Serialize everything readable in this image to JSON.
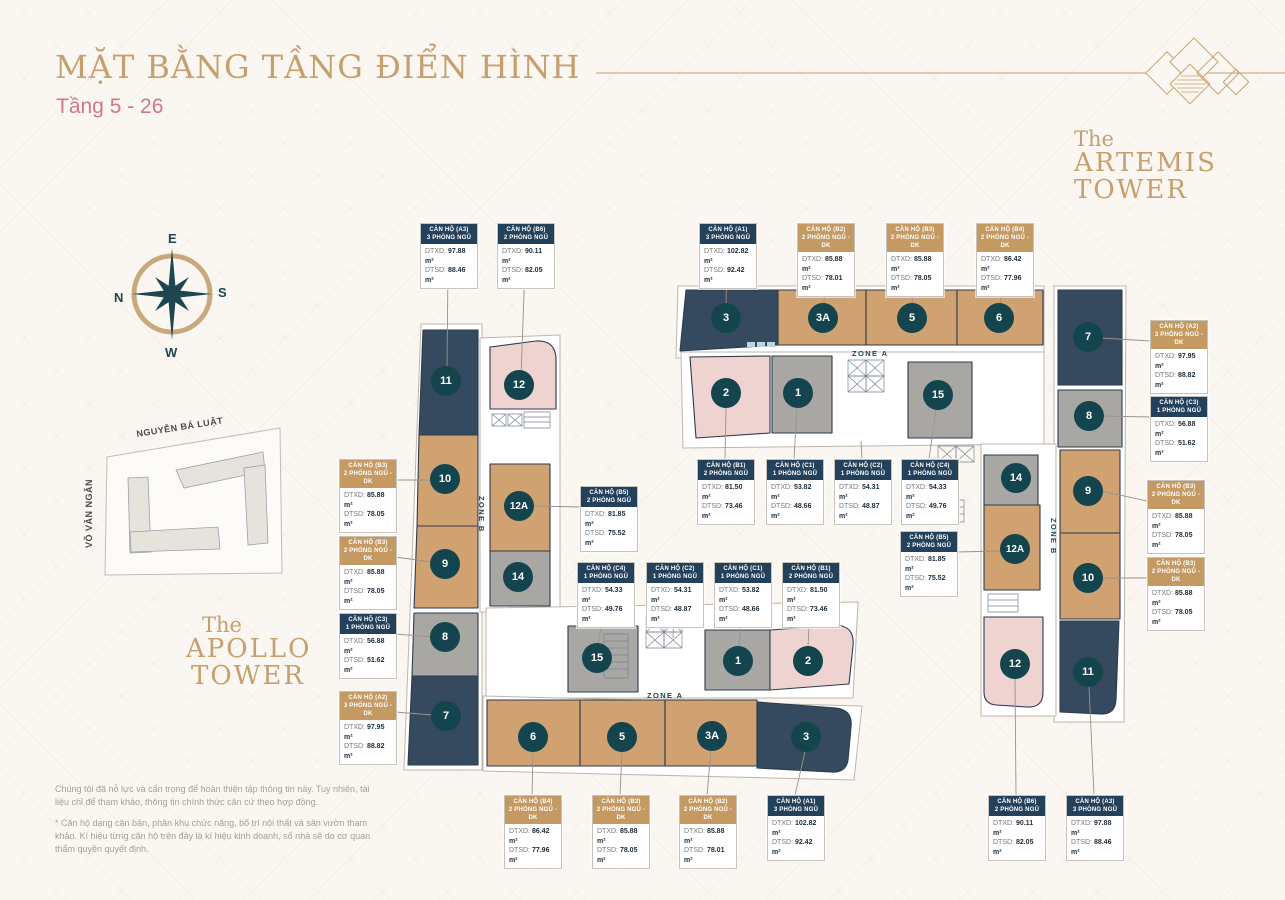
{
  "page": {
    "title": "MẶT BẰNG TẦNG ĐIỂN HÌNH",
    "subtitle": "Tầng 5 - 26"
  },
  "towers": {
    "apollo": {
      "pre": "The",
      "name": "APOLLO",
      "suffix": "TOWER"
    },
    "artemis": {
      "pre": "The",
      "name": "ARTEMIS",
      "suffix": "TOWER"
    }
  },
  "compass": {
    "top": "E",
    "right": "S",
    "bottom": "W",
    "left": "N"
  },
  "map": {
    "street_top": "NGUYỄN BÁ LUẬT",
    "street_left": "VÕ VĂN NGÂN"
  },
  "labels": {
    "dtxd": "DTXD:",
    "dtsd": "DTSD:",
    "zone_a": "ZONE A",
    "zone_b": "ZONE B"
  },
  "apollo_units": [
    "11",
    "12",
    "10",
    "12A",
    "9",
    "14",
    "8",
    "15",
    "7",
    "1",
    "2",
    "6",
    "5",
    "3A",
    "3"
  ],
  "artemis_units": [
    "3",
    "3A",
    "5",
    "6",
    "7",
    "2",
    "1",
    "15",
    "8",
    "14",
    "9",
    "12A",
    "10",
    "12",
    "11"
  ],
  "callouts": {
    "apollo_top": [
      {
        "title": "CĂN HỘ (A3)",
        "subtitle": "3 PHÒNG NGỦ",
        "type": "navy",
        "dtxd": "97.88 m²",
        "dtsd": "88.46 m²"
      },
      {
        "title": "CĂN HỘ (B6)",
        "subtitle": "2 PHÒNG NGỦ",
        "type": "navy",
        "dtxd": "90.11 m²",
        "dtsd": "82.05 m²"
      }
    ],
    "artemis_top": [
      {
        "title": "CĂN HỘ (A1)",
        "subtitle": "3 PHÒNG NGỦ",
        "type": "navy",
        "dtxd": "102.82 m²",
        "dtsd": "92.42 m²"
      },
      {
        "title": "CĂN HỘ (B2)",
        "subtitle": "2 PHÒNG NGỦ - DK",
        "type": "tan",
        "dtxd": "85.88 m²",
        "dtsd": "78.01 m²"
      },
      {
        "title": "CĂN HỘ (B3)",
        "subtitle": "2 PHÒNG NGỦ - DK",
        "type": "tan",
        "dtxd": "85.88 m²",
        "dtsd": "78.05 m²"
      },
      {
        "title": "CĂN HỘ (B4)",
        "subtitle": "2 PHÒNG NGỦ - DK",
        "type": "tan",
        "dtxd": "86.42 m²",
        "dtsd": "77.96 m²"
      }
    ],
    "artemis_right": [
      {
        "title": "CĂN HỘ (A2)",
        "subtitle": "3 PHÒNG NGỦ - DK",
        "type": "tan",
        "dtxd": "97.95 m²",
        "dtsd": "88.82 m²"
      },
      {
        "title": "CĂN HỘ (C3)",
        "subtitle": "1 PHÒNG NGỦ",
        "type": "navy",
        "dtxd": "56.88 m²",
        "dtsd": "51.62 m²"
      },
      {
        "title": "CĂN HỘ (B3)",
        "subtitle": "2 PHÒNG NGỦ - DK",
        "type": "tan",
        "dtxd": "85.88 m²",
        "dtsd": "78.05 m²"
      },
      {
        "title": "CĂN HỘ (B3)",
        "subtitle": "2 PHÒNG NGỦ - DK",
        "type": "tan",
        "dtxd": "85.88 m²",
        "dtsd": "78.05 m²"
      }
    ],
    "apollo_left": [
      {
        "title": "CĂN HỘ (B3)",
        "subtitle": "2 PHÒNG NGỦ - DK",
        "type": "tan",
        "dtxd": "85.88 m²",
        "dtsd": "78.05 m²"
      },
      {
        "title": "CĂN HỘ (B3)",
        "subtitle": "2 PHÒNG NGỦ - DK",
        "type": "tan",
        "dtxd": "85.88 m²",
        "dtsd": "78.05 m²"
      },
      {
        "title": "CĂN HỘ (C3)",
        "subtitle": "1 PHÒNG NGỦ",
        "type": "navy",
        "dtxd": "56.88 m²",
        "dtsd": "51.62 m²"
      },
      {
        "title": "CĂN HỘ (A2)",
        "subtitle": "3 PHÒNG NGỦ - DK",
        "type": "tan",
        "dtxd": "97.95 m²",
        "dtsd": "88.82 m²"
      }
    ],
    "apollo_center": [
      {
        "title": "CĂN HỘ (B5)",
        "subtitle": "2 PHÒNG NGỦ",
        "type": "navy",
        "dtxd": "81.85 m²",
        "dtsd": "75.52 m²"
      },
      {
        "title": "CĂN HỘ (C4)",
        "subtitle": "1 PHÒNG NGỦ",
        "type": "navy",
        "dtxd": "54.33 m²",
        "dtsd": "49.76 m²"
      },
      {
        "title": "CĂN HỘ (C2)",
        "subtitle": "1 PHÒNG NGỦ",
        "type": "navy",
        "dtxd": "54.31 m²",
        "dtsd": "48.87 m²"
      },
      {
        "title": "CĂN HỘ (C1)",
        "subtitle": "1 PHÒNG NGỦ",
        "type": "navy",
        "dtxd": "53.82 m²",
        "dtsd": "48.66 m²"
      },
      {
        "title": "CĂN HỘ (B1)",
        "subtitle": "2 PHÒNG NGỦ",
        "type": "navy",
        "dtxd": "81.50 m²",
        "dtsd": "73.46 m²"
      }
    ],
    "artemis_center": [
      {
        "title": "CĂN HỘ (B1)",
        "subtitle": "2 PHÒNG NGỦ",
        "type": "navy",
        "dtxd": "81.50 m²",
        "dtsd": "73.46 m²"
      },
      {
        "title": "CĂN HỘ (C1)",
        "subtitle": "1 PHÒNG NGỦ",
        "type": "navy",
        "dtxd": "53.82 m²",
        "dtsd": "48.66 m²"
      },
      {
        "title": "CĂN HỘ (C2)",
        "subtitle": "1 PHÒNG NGỦ",
        "type": "navy",
        "dtxd": "54.31 m²",
        "dtsd": "48.87 m²"
      },
      {
        "title": "CĂN HỘ (C4)",
        "subtitle": "1 PHÒNG NGỦ",
        "type": "navy",
        "dtxd": "54.33 m²",
        "dtsd": "49.76 m²"
      },
      {
        "title": "CĂN HỘ (B5)",
        "subtitle": "2 PHÒNG NGỦ",
        "type": "navy",
        "dtxd": "81.85 m²",
        "dtsd": "75.52 m²"
      }
    ],
    "apollo_bottom": [
      {
        "title": "CĂN HỘ (B4)",
        "subtitle": "2 PHÒNG NGỦ - DK",
        "type": "tan",
        "dtxd": "86.42 m²",
        "dtsd": "77.96 m²"
      },
      {
        "title": "CĂN HỘ (B3)",
        "subtitle": "2 PHÒNG NGỦ - DK",
        "type": "tan",
        "dtxd": "85.88 m²",
        "dtsd": "78.05 m²"
      },
      {
        "title": "CĂN HỘ (B2)",
        "subtitle": "2 PHÒNG NGỦ - DK",
        "type": "tan",
        "dtxd": "85.88 m²",
        "dtsd": "78.01 m²"
      },
      {
        "title": "CĂN HỘ (A1)",
        "subtitle": "3 PHÒNG NGỦ",
        "type": "navy",
        "dtxd": "102.82 m²",
        "dtsd": "92.42 m²"
      }
    ],
    "artemis_bottom": [
      {
        "title": "CĂN HỘ (B6)",
        "subtitle": "2 PHÒNG NGỦ",
        "type": "navy",
        "dtxd": "90.11 m²",
        "dtsd": "82.05 m²"
      },
      {
        "title": "CĂN HỘ (A3)",
        "subtitle": "3 PHÒNG NGỦ",
        "type": "navy",
        "dtxd": "97.88 m²",
        "dtsd": "88.46 m²"
      }
    ]
  },
  "disclaimer": {
    "p1": "Chúng tôi đã nỗ lực và cẩn trọng để hoàn thiện tập thông tin này. Tuy nhiên, tài liệu chỉ để tham khảo, thông tin chính thức căn cứ theo hợp đồng.",
    "p2": "* Căn hộ dạng căn bản, phân khu chức năng, bố trí nội thất và sân vườn tham khảo. Kí hiệu từng căn hộ trên đây là kí hiệu kinh doanh, số nhà sẽ do cơ quan thẩm quyền quyết định."
  },
  "palette": {
    "accent_gold": "#c5a06e",
    "subtitle_pink": "#cb7a85",
    "unit_navy": "#35495f",
    "unit_tan": "#d0a271",
    "unit_pink": "#eed3d0",
    "unit_gray": "#a9a7a4",
    "circle_teal": "#14454e",
    "header_navy": "#24415b",
    "header_tan": "#c49a62"
  }
}
